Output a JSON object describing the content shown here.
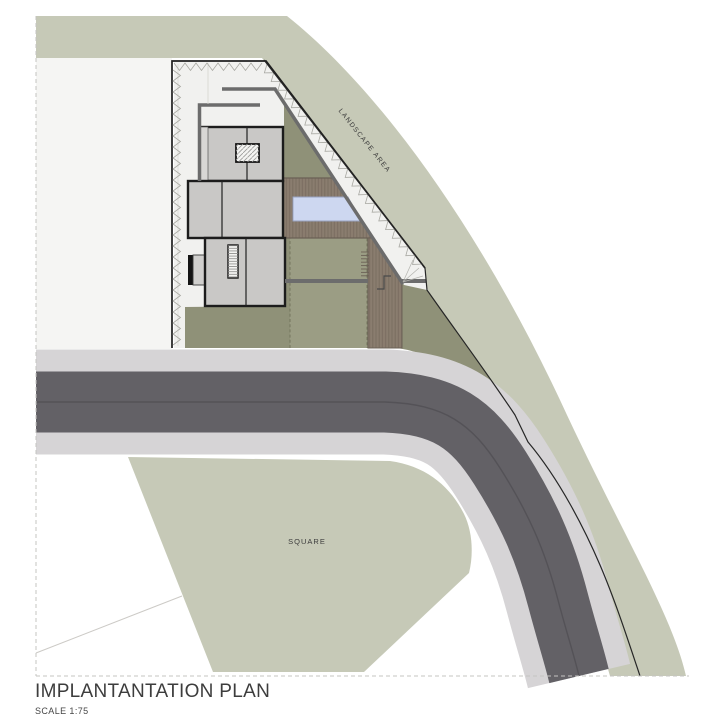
{
  "drawing": {
    "title": "IMPLANTANTATION PLAN",
    "scale_label": "SCALE 1:75",
    "labels": {
      "landscape_area": "LANDSCAPE AREA",
      "square": "SQUARE"
    }
  },
  "colors": {
    "page_bg": "#ffffff",
    "landscape_green": "#c6c9b7",
    "garden_green": "#8f9178",
    "lawn_green": "#9b9d84",
    "paving_white": "#f1f1ef",
    "plot_white": "#f5f5f3",
    "deck_brown": "#8a7d6f",
    "pool_blue": "#cdd7f0",
    "building_gray": "#c9c8c6",
    "building_light_gray": "#d8d7d5",
    "building_outline": "#1c1c1c",
    "wall_gray": "#6c6c6c",
    "road_dark": "#636166",
    "sidewalk_gray": "#d6d4d6",
    "boundary_black": "#1f1f1f",
    "text_dark": "#3c3c3c"
  }
}
